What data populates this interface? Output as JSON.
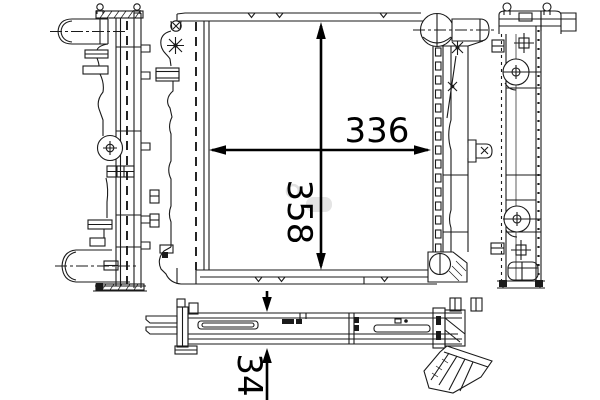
{
  "drawing": {
    "subject": "radiator technical drawing, four orthographic views",
    "dimension_labels": {
      "width": "336",
      "height": "358",
      "depth": "34"
    },
    "colors": {
      "line": "#1a1a1a",
      "background": "#ffffff",
      "watermark": "#e4e4e4"
    }
  }
}
